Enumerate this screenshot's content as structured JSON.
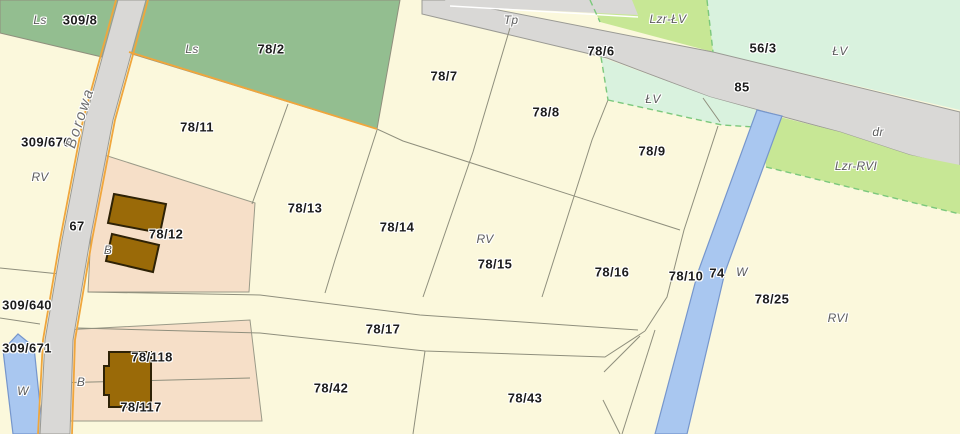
{
  "map": {
    "street_name": "Borowa",
    "parcel_labels": [
      {
        "text": "309/8",
        "x": 80,
        "y": 20
      },
      {
        "text": "78/2",
        "x": 271,
        "y": 49
      },
      {
        "text": "78/7",
        "x": 444,
        "y": 76
      },
      {
        "text": "78/6",
        "x": 601,
        "y": 51
      },
      {
        "text": "78/8",
        "x": 546,
        "y": 112
      },
      {
        "text": "56/3",
        "x": 763,
        "y": 48
      },
      {
        "text": "85",
        "x": 742,
        "y": 87
      },
      {
        "text": "309/676",
        "x": 46,
        "y": 142
      },
      {
        "text": "78/11",
        "x": 197,
        "y": 127
      },
      {
        "text": "78/9",
        "x": 652,
        "y": 151
      },
      {
        "text": "67",
        "x": 77,
        "y": 226
      },
      {
        "text": "78/13",
        "x": 305,
        "y": 208
      },
      {
        "text": "78/12",
        "x": 166,
        "y": 234
      },
      {
        "text": "78/14",
        "x": 397,
        "y": 227
      },
      {
        "text": "78/15",
        "x": 495,
        "y": 264
      },
      {
        "text": "78/16",
        "x": 612,
        "y": 272
      },
      {
        "text": "78/10",
        "x": 686,
        "y": 276
      },
      {
        "text": "74",
        "x": 717,
        "y": 273
      },
      {
        "text": "78/25",
        "x": 772,
        "y": 299
      },
      {
        "text": "309/640",
        "x": 27,
        "y": 305
      },
      {
        "text": "309/671",
        "x": 27,
        "y": 348
      },
      {
        "text": "78/17",
        "x": 383,
        "y": 329
      },
      {
        "text": "78/118",
        "x": 152,
        "y": 357
      },
      {
        "text": "78/117",
        "x": 141,
        "y": 407
      },
      {
        "text": "78/42",
        "x": 331,
        "y": 388
      },
      {
        "text": "78/43",
        "x": 525,
        "y": 398
      }
    ],
    "landuse_labels": [
      {
        "text": "Ls",
        "x": 40,
        "y": 20
      },
      {
        "text": "Ls",
        "x": 192,
        "y": 49
      },
      {
        "text": "Tp",
        "x": 511,
        "y": 20
      },
      {
        "text": "Lzr-ŁV",
        "x": 668,
        "y": 19
      },
      {
        "text": "ŁV",
        "x": 840,
        "y": 51
      },
      {
        "text": "ŁV",
        "x": 653,
        "y": 99
      },
      {
        "text": "dr",
        "x": 878,
        "y": 132
      },
      {
        "text": "Lzr-RVI",
        "x": 856,
        "y": 166
      },
      {
        "text": "RV",
        "x": 40,
        "y": 177
      },
      {
        "text": "RV",
        "x": 485,
        "y": 239
      },
      {
        "text": "RVI",
        "x": 838,
        "y": 318
      },
      {
        "text": "W",
        "x": 742,
        "y": 272
      },
      {
        "text": "W",
        "x": 23,
        "y": 391
      },
      {
        "text": "B",
        "x": 108,
        "y": 250
      },
      {
        "text": "B",
        "x": 81,
        "y": 382
      }
    ],
    "street_label": {
      "text": "Borowa",
      "x": 80,
      "y": 118,
      "rotate": -72
    },
    "colors": {
      "parcel_fill": "#FBF8DC",
      "forest_fill": "#93BE90",
      "meadow_mint_fill": "#D9F2DE",
      "shrub_lime_fill": "#C7E795",
      "road_fill": "#D9D8D6",
      "road_edge_orange": "#F0A63C",
      "water_fill": "#A9C7F0",
      "residential_fill": "#F6DFC8",
      "building_fill": "#9A6A08",
      "boundary_line": "#8F8F7D",
      "dashed_class_line": "#7CC87C"
    }
  }
}
